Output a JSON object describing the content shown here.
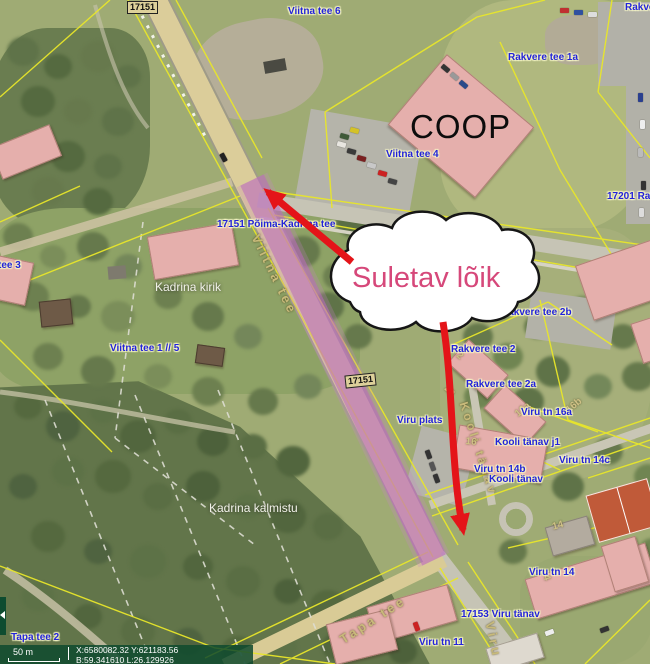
{
  "annotation": {
    "cloud_text": "Suletav lõik"
  },
  "badges": {
    "top": "17151",
    "road": "17151"
  },
  "labels": {
    "viitna_tee_6": "Viitna tee 6",
    "rakvere_corner": "Rakvere",
    "rakvere_tee_1a": "Rakvere tee 1a",
    "coop": "COOP",
    "viitna_tee_4": "Viitna tee 4",
    "r17201_rakvere": "17201 Rakvere",
    "pohja_kadrina_tee": "17151 Põima-Kadrina tee",
    "tee_3": "tee 3",
    "kadrina_kirik": "Kadrina kirik",
    "viitna_tee_1_5": "Viitna tee 1 // 5",
    "rakvere_tee_2b": "Rakvere tee 2b",
    "rakvere_tee_2": "Rakvere tee 2",
    "rakvere_tee_2a": "Rakvere tee 2a",
    "viru_tn_16a": "Viru tn 16a",
    "viru_plats": "Viru plats",
    "kooli_tanav_j1": "Kooli tänav j1",
    "viru_tn_14c": "Viru tn 14c",
    "viru_tn_14b": "Viru tn 14b",
    "kooli_tanav": "Kooli tänav",
    "kadrina_kalmistu": "Kadrina kalmistu",
    "viru_tn_14": "Viru tn 14",
    "viru_tanav_17153": "17153 Viru tänav",
    "viru_tn_11": "Viru tn 11",
    "tapa_tee_2": "Tapa tee 2"
  },
  "street_names": {
    "viitna_tee": "Viitna tee",
    "kooli_tanav": "Kooli tänav",
    "tapa_tee": "Tapa tee",
    "viru": "Viru"
  },
  "building_numbers": {
    "n2": "2",
    "n2a": "2a",
    "n16": "16",
    "n16a": "16a",
    "n16b": "16b",
    "n14": "14",
    "n14r": "14"
  },
  "statusbar": {
    "scale": "50 m",
    "coord1": "X:6580082.32 Y:621183.56",
    "coord2": "B:59.341610 L:26.129926"
  },
  "colors": {
    "annotation_pink": "#d6487a",
    "arrow_red": "#e41419",
    "closed_road_overlay": "#bc6abe",
    "cadastral_yellow": "#e8e62a",
    "address_label_blue": "#2222da"
  }
}
